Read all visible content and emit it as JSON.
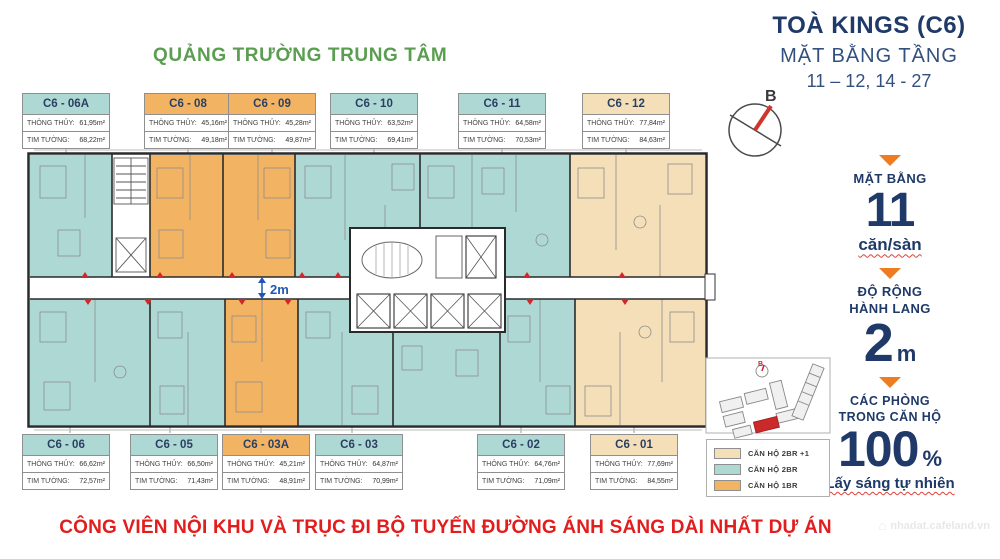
{
  "header": {
    "building": "TOÀ KINGS (C6)",
    "subtitle": "MẶT BẰNG TẦNG",
    "floors": "11 – 12, 14 - 27"
  },
  "plaza_label": "QUẢNG TRƯỜNG TRUNG TÂM",
  "compass": {
    "label": "B"
  },
  "labels": {
    "thong_thuy": "THÔNG THỦY:",
    "tim_tuong": "TIM TƯỜNG:"
  },
  "top_units": [
    {
      "id": "C6 - 06A",
      "type": "2br",
      "thong_thuy": "61,95m²",
      "tim_tuong": "68,22m²"
    },
    {
      "id": "C6 - 08",
      "type": "1br",
      "thong_thuy": "45,16m²",
      "tim_tuong": "49,18m²"
    },
    {
      "id": "C6 - 09",
      "type": "1br",
      "thong_thuy": "45,28m²",
      "tim_tuong": "49,87m²"
    },
    {
      "id": "C6 - 10",
      "type": "2br",
      "thong_thuy": "63,52m²",
      "tim_tuong": "69,41m²"
    },
    {
      "id": "C6 - 11",
      "type": "2br",
      "thong_thuy": "64,58m²",
      "tim_tuong": "70,53m²"
    },
    {
      "id": "C6 - 12",
      "type": "2br1",
      "thong_thuy": "77,84m²",
      "tim_tuong": "84,63m²"
    }
  ],
  "bottom_units": [
    {
      "id": "C6 - 06",
      "type": "2br",
      "thong_thuy": "66,62m²",
      "tim_tuong": "72,57m²"
    },
    {
      "id": "C6 - 05",
      "type": "2br",
      "thong_thuy": "66,50m²",
      "tim_tuong": "71,43m²"
    },
    {
      "id": "C6 - 03A",
      "type": "1br",
      "thong_thuy": "45,21m²",
      "tim_tuong": "48,91m²"
    },
    {
      "id": "C6 - 03",
      "type": "2br",
      "thong_thuy": "64,87m²",
      "tim_tuong": "70,99m²"
    },
    {
      "id": "C6 - 02",
      "type": "2br",
      "thong_thuy": "64,76m²",
      "tim_tuong": "71,09m²"
    },
    {
      "id": "C6 - 01",
      "type": "2br1",
      "thong_thuy": "77,69m²",
      "tim_tuong": "84,55m²"
    }
  ],
  "corridor_width_label": "2m",
  "panels": {
    "mat_bang": {
      "title": "MẶT BẰNG",
      "value": "11",
      "unit": "căn/sàn"
    },
    "do_rong": {
      "title_line1": "ĐỘ RỘNG",
      "title_line2": "HÀNH LANG",
      "value": "2",
      "unit": "m"
    },
    "cac_phong": {
      "title_line1": "CÁC PHÒNG",
      "title_line2": "TRONG CĂN HỘ",
      "value": "100",
      "unit": "%",
      "subtitle": "Lấy sáng tự nhiên"
    }
  },
  "legend": [
    {
      "label": "CĂN HỘ 2BR +1",
      "type": "2br1"
    },
    {
      "label": "CĂN HỘ 2BR",
      "type": "2br"
    },
    {
      "label": "CĂN HỘ 1BR",
      "type": "1br"
    }
  ],
  "banner": "CÔNG VIÊN NỘI KHU VÀ TRỤC ĐI BỘ TUYẾN ĐƯỜNG ÁNH SÁNG DÀI NHẤT DỰ ÁN",
  "watermark": "nhadat.cafeland.vn",
  "colors": {
    "teal": "#aed8d4",
    "orange": "#f2b363",
    "cream": "#f4dfb8",
    "navy": "#1f3a68",
    "green": "#5b9e51",
    "red": "#e11d1d",
    "triangle_orange": "#ee7d22",
    "corridor_blue": "#2156b8"
  }
}
